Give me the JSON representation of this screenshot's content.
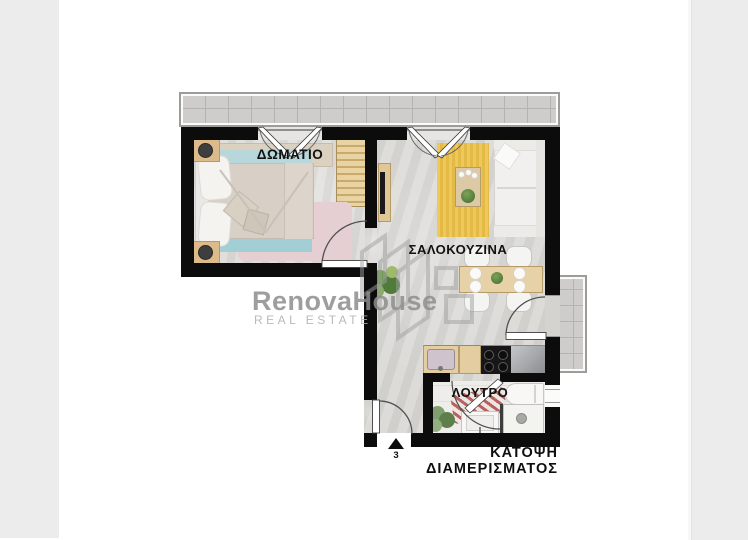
{
  "document": {
    "type": "apartment-floor-plan"
  },
  "caption": {
    "line1": "ΚΑΤΟΨΗ",
    "line2": "ΔΙΑΜΕΡΙΣΜΑΤΟΣ"
  },
  "rooms": {
    "bedroom": {
      "label": "ΔΩΜΑΤΙΟ",
      "furniture": [
        "double-bed",
        "headboard-pillows",
        "nightstand-with-lamp-top",
        "nightstand-with-lamp-bottom",
        "wardrobe",
        "console-shelf",
        "pink-rug",
        "blue-bed-runners"
      ]
    },
    "living_kitchen": {
      "label": "ΣΑΛΟΚΟΥΖΙΝΑ",
      "furniture": [
        "sofa",
        "coffee-table-with-plant",
        "yellow-rug",
        "tv-unit",
        "dining-table",
        "four-chairs",
        "four-plates",
        "kitchen-sink-cabinet",
        "stove-four-burners",
        "stainless-counter",
        "floor-plants"
      ]
    },
    "bathroom": {
      "label": "ΛΟΥΤΡΟ",
      "furniture": [
        "bathtub",
        "shower-with-drain",
        "vanity-sink",
        "striped-rug",
        "plant"
      ]
    }
  },
  "outdoor": {
    "top_balcony": "tiled-terrace",
    "right_balcony": "tiled-balcony"
  },
  "entrance": {
    "number": "3",
    "marker": "triangle-arrow-up"
  },
  "watermark": {
    "brand": "RenovaHouse",
    "tagline": "REAL ESTATE"
  },
  "colors": {
    "wall": "#0c0c0c",
    "floor": "#d8d7d4",
    "bedroom_floor": "#dcdbd8",
    "bathroom_floor": "#efedea",
    "balcony_tile": "#cecdcb",
    "rug_yellow": "#edc24a",
    "rug_pink": "#e6cfd3",
    "bed_runner_top": "#b7d7da",
    "bed_runner_bottom": "#a2ced6",
    "duvet": "#d8d0c6",
    "wood": "#e3cda1",
    "stove": "#171717",
    "sink_basin": "#cfc3ce",
    "bath_rug_red": "#b65a58",
    "side_panel_gray": "#ececec",
    "watermark_gray": "#8e8e8e"
  }
}
